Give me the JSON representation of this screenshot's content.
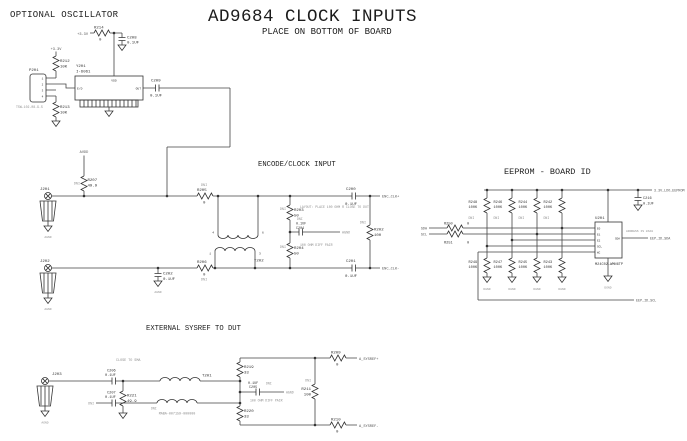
{
  "header": {
    "osc_heading": "OPTIONAL OSCILLATOR",
    "title": "AD9684 CLOCK INPUTS",
    "subtitle": "PLACE ON BOTTOM OF BOARD"
  },
  "nets": {
    "agnd": "AGND",
    "dgnd": "DGND"
  },
  "osc": {
    "net_a": "+3.3V",
    "net_b": "+3.3V",
    "r214_ref": "R214",
    "r214_val": "0",
    "c208_ref": "C208",
    "c208_val": "0.1UF",
    "r212_ref": "R212",
    "r212_val": "10K",
    "r213_ref": "R213",
    "r213_val": "10K",
    "p201_ref": "P201",
    "p201_part": "TSW-102-08-G-S",
    "p201_pins": [
      "1",
      "2",
      "3",
      "4"
    ],
    "y201_ref": "Y201",
    "y201_val": "I-6061",
    "y201_vdd": "VDD",
    "y201_out": "OUT",
    "y201_ed": "E/D",
    "c209_ref": "C209",
    "c209_val": "0.1UF"
  },
  "encode": {
    "heading": "ENCODE/CLOCK INPUT",
    "j201_ref": "J201",
    "j202_ref": "J202",
    "r207_ref": "R207",
    "r207_val": "49.9",
    "r207_dni": "DNI",
    "r207_net": "AVDD",
    "r205_ref": "R205",
    "r205_val": "0",
    "r205_dni": "DNI",
    "r206_ref": "R206",
    "r206_val": "0",
    "r206_dni": "DNI",
    "c202_ref": "C202",
    "c202_val": "0.1UF",
    "t202_ref": "T202",
    "t202_pins": [
      "4",
      "6",
      "1",
      "3"
    ],
    "r203_ref": "R203",
    "r203_val": "50",
    "r203_dni": "DNI",
    "r204_ref": "R204",
    "r204_val": "50",
    "r204_dni": "DNI",
    "c204_ref": "C204",
    "c204_val": "0.1UF",
    "c204_dni": "DNI",
    "note_layout": "LAYOUT: PLACE 100 OHM R CLOSE TO DUT",
    "note_pair": "100 OHM DIFF PAIR",
    "c200_ref": "C200",
    "c200_val": "0.1UF",
    "c201_ref": "C201",
    "c201_val": "0.1UF",
    "r202_ref": "R202",
    "r202_val": "100",
    "r202_dni": "DNI",
    "net_clk_p": "ENC_CLK+",
    "net_clk_m": "ENC_CLK-"
  },
  "eeprom": {
    "heading": "EEPROM - BOARD ID",
    "net_3v3": "3.3V_LDO_EEPROM",
    "c216_ref": "C216",
    "c216_val": "0.1UF",
    "pullups": [
      {
        "ref": "R248",
        "val": "100K",
        "dni": "DNI"
      },
      {
        "ref": "R246",
        "val": "100K",
        "dni": "DNI"
      },
      {
        "ref": "R244",
        "val": "100K",
        "dni": "DNI"
      },
      {
        "ref": "R242",
        "val": "100K",
        "dni": "DNI"
      }
    ],
    "pulldowns": [
      {
        "ref": "R249",
        "val": "100K"
      },
      {
        "ref": "R247",
        "val": "100K"
      },
      {
        "ref": "R245",
        "val": "100K"
      },
      {
        "ref": "R243",
        "val": "100K"
      }
    ],
    "r250_ref": "R250",
    "r250_val": "0",
    "r251_ref": "R251",
    "r251_val": "0",
    "net_sda": "SDA",
    "net_scl": "SCL",
    "u201_ref": "U201",
    "u201_part": "M24C02-WMN6TP",
    "u201_note": "ADDRESS IS 0XA0",
    "pins_left": [
      "E0",
      "E1",
      "E2",
      "SCL",
      "WC"
    ],
    "pin_sda": "SDA",
    "net_id_sda": "EEP_ID_SDA",
    "net_id_scl": "EEP_ID_SCL"
  },
  "sysref": {
    "heading": "EXTERNAL SYSREF TO DUT",
    "note_sma": "CLOSE TO SMA",
    "j203_ref": "J203",
    "r221_ref": "R221",
    "r221_val": "49.9",
    "c206_ref": "C206",
    "c206_val": "0.1UF",
    "c207_ref": "C207",
    "c207_val": "0.1UF",
    "c207_dni": "DNI",
    "t201_ref": "T201",
    "t201_part": "MABA-007159-000000",
    "t201_dni": "DNI",
    "r219_ref": "R219",
    "r219_val": "33",
    "r220_ref": "R220",
    "r220_val": "33",
    "c205_ref": "C205",
    "c205_val": "0.1UF",
    "c205_dni": "DNI",
    "note_pair": "100 OHM DIFF PAIR",
    "r211_ref": "R211",
    "r211_val": "100",
    "r211_dni": "DNI",
    "r209_ref": "R209",
    "r209_val": "0",
    "r210_ref": "R210",
    "r210_val": "0",
    "net_p": "A_SYSREF+",
    "net_m": "A_SYSREF-"
  }
}
